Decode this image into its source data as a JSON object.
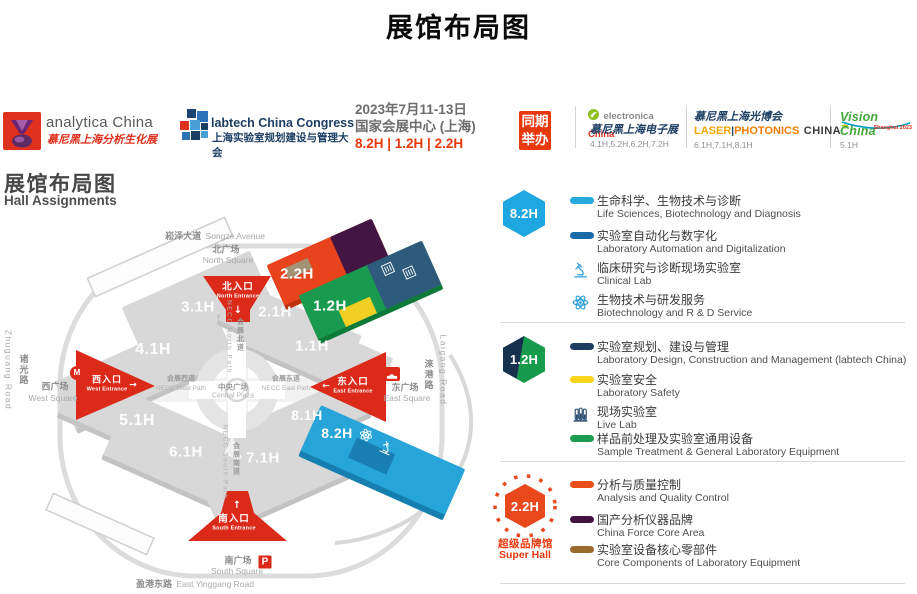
{
  "title": "展馆布局图",
  "header": {
    "analytica": {
      "name": "analytica China",
      "tagline_cn": "慕尼黑上海分析生化展"
    },
    "labtech": {
      "name": "labtech China Congress",
      "tagline_cn": "上海实验室规划建设与管理大会"
    },
    "event": {
      "date": "2023年7月11-13日",
      "venue": "国家会展中心 (上海)",
      "halls": "8.2H | 1.2H | 2.2H"
    },
    "concurrent_badge": {
      "line1": "同期",
      "line2": "举办"
    },
    "co_events": {
      "electronica": {
        "brand": "electronica",
        "brand_region": "China",
        "cn": "慕尼黑上海电子展",
        "halls": "4.1H,5.2H,6.2H,7.2H"
      },
      "laser": {
        "cn": "慕尼黑上海光博会",
        "word1": "LASER",
        "sep": "|",
        "word2": "PHOTONICS",
        "word3": "CHINA",
        "plus": "+",
        "halls": "6.1H,7.1H,8.1H"
      },
      "vision": {
        "brand": "Vision China",
        "sub": "Shanghai 2023",
        "halls": "5.1H"
      }
    }
  },
  "map": {
    "title_cn": "展馆布局图",
    "title_en": "Hall Assignments",
    "halls": {
      "h31": "3.1H",
      "h41": "4.1H",
      "h21": "2.1H",
      "h11": "1.1H",
      "h22": "2.2H",
      "h12": "1.2H",
      "h51": "5.1H",
      "h61": "6.1H",
      "h71": "7.1H",
      "h81": "8.1H",
      "h82": "8.2H"
    },
    "entrances": {
      "north": {
        "cn": "北入口",
        "en": "North Entrance",
        "arrow": "↓"
      },
      "west": {
        "cn": "西入口",
        "en": "West Entrance",
        "arrow": "→"
      },
      "east": {
        "cn": "东入口",
        "en": "East Entrance",
        "arrow": "←"
      },
      "south": {
        "cn": "南入口",
        "en": "South Entrance",
        "arrow": "↑"
      }
    },
    "roads": {
      "songze": {
        "cn": "崧泽大道",
        "en": "Songze Avenue"
      },
      "north_square": {
        "cn": "北广场",
        "en": "North Square"
      },
      "west_square": {
        "cn": "西广场",
        "en": "West Square"
      },
      "east_square": {
        "cn": "东广场",
        "en": "East Square"
      },
      "south_square": {
        "cn": "南广场",
        "en": "South Square"
      },
      "yinggang": {
        "cn": "盈港东路",
        "en": "East Yinggang Road"
      },
      "zhuguang": {
        "cn": "诸光路",
        "en": "Zhuguang Road"
      },
      "laigang": {
        "cn": "涞港路",
        "en": "Laigang Road"
      },
      "necc_north": {
        "cn": "会展北道",
        "en": "NECC North Path"
      },
      "necc_south": {
        "cn": "会展南道",
        "en": "NECC South Path"
      },
      "necc_west": {
        "cn": "会展西道",
        "en": "NECC West Path"
      },
      "necc_east": {
        "cn": "会展东道",
        "en": "NECC East Path"
      },
      "central_plaza": {
        "cn": "中央广场",
        "en": "Central Plaza"
      }
    },
    "markers": {
      "taxi": "TAXI",
      "parking": "P",
      "metro": "M"
    },
    "hall_colors": {
      "h82": "#27a5d9",
      "h12_green": "#1a9a4f",
      "h12_navy": "#2e5b7c",
      "h12_yellow": "#f2d023",
      "h22_orange": "#e8431c",
      "h22_purple": "#431543",
      "gray": "#d8d8d8",
      "entrance_red": "#dc2a1a"
    }
  },
  "legend": {
    "sections": [
      {
        "badge": "8.2H",
        "badge_color": "#1ea7e0",
        "items": [
          {
            "type": "swatch",
            "color": "#29aade",
            "zh": "生命科学、生物技术与诊断",
            "en": "Life Sciences, Biotechnology and Diagnosis"
          },
          {
            "type": "swatch",
            "color": "#1b6aa8",
            "zh": "实验室自动化与数字化",
            "en": "Laboratory Automation and Digitalization"
          },
          {
            "type": "icon",
            "icon": "microscope",
            "zh": "临床研究与诊断现场实验室",
            "en": "Clinical Lab"
          },
          {
            "type": "icon",
            "icon": "atom",
            "zh": "生物技术与研发服务",
            "en": "Biotechnology and R & D Service"
          }
        ]
      },
      {
        "badge": "1.2H",
        "badge_color_left": "#16304d",
        "badge_color_right": "#169a4c",
        "items": [
          {
            "type": "swatch",
            "color": "#1f3e61",
            "zh": "实验室规划、建设与管理",
            "en": "Laboratory Design, Construction and Management (labtech China)"
          },
          {
            "type": "swatch",
            "color": "#f8d41c",
            "zh": "实验室安全",
            "en": "Laboratory Safety"
          },
          {
            "type": "icon",
            "icon": "test-tubes",
            "zh": "现场实验室",
            "en": "Live Lab"
          },
          {
            "type": "swatch",
            "color": "#1d9b4e",
            "zh": "样品前处理及实验室通用设备",
            "en": "Sample Treatment & General Laboratory Equipment"
          }
        ]
      },
      {
        "badge": "2.2H",
        "badge_color": "#e8481c",
        "sub_cn": "超级品牌馆",
        "sub_en": "Super Hall",
        "items": [
          {
            "type": "swatch",
            "color": "#e94e1b",
            "zh": "分析与质量控制",
            "en": "Analysis and Quality Control"
          },
          {
            "type": "swatch",
            "color": "#451343",
            "zh": "国产分析仪器品牌",
            "en": "China Force Core Area"
          },
          {
            "type": "swatch",
            "color": "#9b6b2d",
            "zh": "实验室设备核心零部件",
            "en": "Core Components of Laboratory Equipment"
          }
        ]
      }
    ]
  }
}
